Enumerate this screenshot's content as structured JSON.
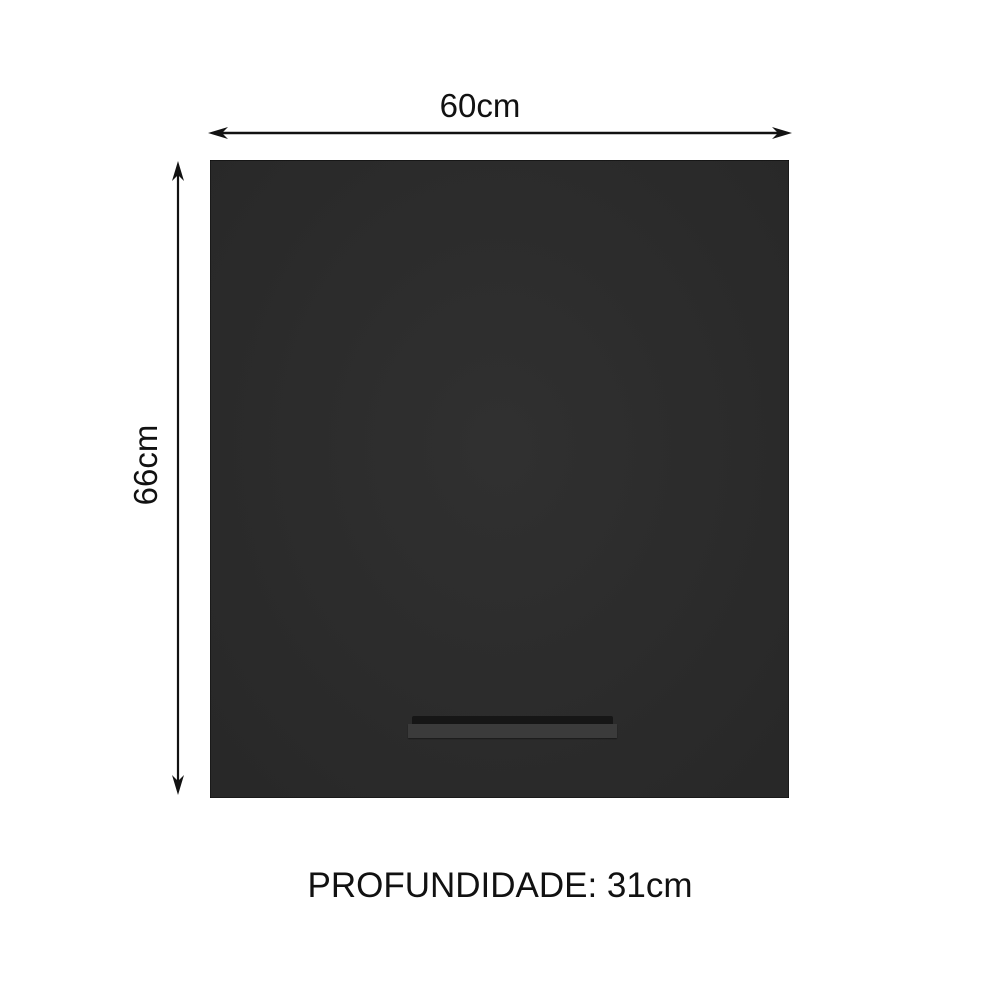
{
  "diagram": {
    "title": "cabinet dimensions diagram",
    "width_label": "60cm",
    "height_label": "66cm",
    "depth_label": "PROFUNDIDADE: 31cm"
  },
  "icons": {
    "horizontal_arrow": "double-headed-dimension-arrow",
    "vertical_arrow": "double-headed-dimension-arrow"
  },
  "colors": {
    "background": "#ffffff",
    "cabinet": "#2c2c2c",
    "handle": "#3b3b3b",
    "handle_shadow": "#161616",
    "arrow": "#121212",
    "text": "#111111"
  }
}
